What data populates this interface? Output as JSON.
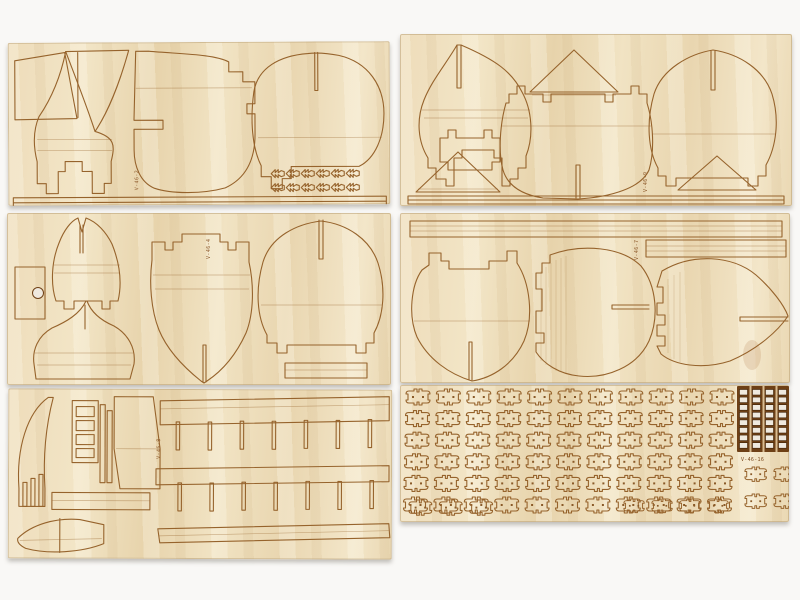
{
  "scene": {
    "subject": "six laser-cut birch plywood sheets of a wooden model ship kit laid out on a white surface",
    "colors": {
      "background": "#f9f8f6",
      "wood": "#ecd9b5",
      "wood_light": "#f4e8cc",
      "wood_dark": "#e0c89e",
      "cut_line": "#96632c",
      "char_dark": "#6e4016",
      "shadow": "#b9b4ac",
      "hole": "#efe9df"
    },
    "sheets": [
      {
        "name": "top-left",
        "label": "V-46-2",
        "parts": [
          "stern-panel",
          "mast-sail-triangle",
          "hull-frame",
          "bulkhead-frame-with-tabs",
          "round-bulkhead-frame",
          "cleat-grid",
          "edge-strips"
        ]
      },
      {
        "name": "top-right",
        "label": "V-46-9",
        "parts": [
          "onion-bulkhead",
          "triangle-part",
          "notched-bulkhead",
          "round-bulkhead",
          "triangle-part",
          "edge-strips"
        ]
      },
      {
        "name": "middle-left",
        "label": "V-46-4",
        "parts": [
          "rectangle-with-hole",
          "forked-bulkhead",
          "hull-cross-section",
          "tower-bulkhead",
          "round-bulkhead",
          "small-strip"
        ]
      },
      {
        "name": "middle-right",
        "label": "V-46-7",
        "parts": [
          "long-strip",
          "short-strip",
          "round-bulkhead",
          "gourd-bulkhead",
          "leaf-bulkhead"
        ]
      },
      {
        "name": "bottom-left",
        "label": "V-46-8",
        "parts": [
          "curved-stem",
          "ladder-part",
          "keel-plate",
          "spacer-bar",
          "small-hull",
          "slotted-deck-beam-upper",
          "slotted-deck-beam-lower"
        ]
      },
      {
        "name": "bottom-right",
        "label": "V-46-16",
        "parts": [
          "small-fitting-grid",
          "grating-strips",
          "fitting-group"
        ]
      }
    ]
  },
  "generated": [
    {
      "name": "cleat-part",
      "svg": "s1-svg",
      "href": "#part-fleur",
      "x0": 263,
      "y0": 127,
      "dx": 15,
      "dy": 14,
      "rows": 2,
      "cols": 6,
      "scale": 1
    },
    {
      "name": "small-fitting",
      "svg": "s6-svg",
      "href": "#part-small",
      "x0": 5,
      "y0": 4,
      "dx": 30.4,
      "dy": 21.6,
      "rows": 6,
      "cols": 11,
      "scale": 1,
      "rowdx": -0.5
    },
    {
      "name": "small-fitting",
      "svg": "s6-svg",
      "href": "#part-small",
      "x0": 8,
      "y0": 115,
      "dx": 30.4,
      "dy": 0,
      "rows": 1,
      "cols": 3,
      "scale": 0.95
    },
    {
      "name": "small-fitting",
      "svg": "s6-svg",
      "href": "#part-small",
      "x0": 223,
      "y0": 114,
      "dx": 28,
      "dy": 0,
      "rows": 1,
      "cols": 4,
      "scale": 0.85
    },
    {
      "name": "small-fitting",
      "svg": "s6-svg",
      "href": "#part-small",
      "x0": 344,
      "y0": 82,
      "dx": 29,
      "dy": 27,
      "rows": 2,
      "cols": 2,
      "scale": 0.9
    },
    {
      "name": "grating-hole",
      "svg": "s6-svg",
      "href": "#grating-hole",
      "x0": 339.5,
      "y0": 4.5,
      "dx": 13,
      "dy": 7.6,
      "rows": 8,
      "cols": 4,
      "scale": 1
    }
  ]
}
